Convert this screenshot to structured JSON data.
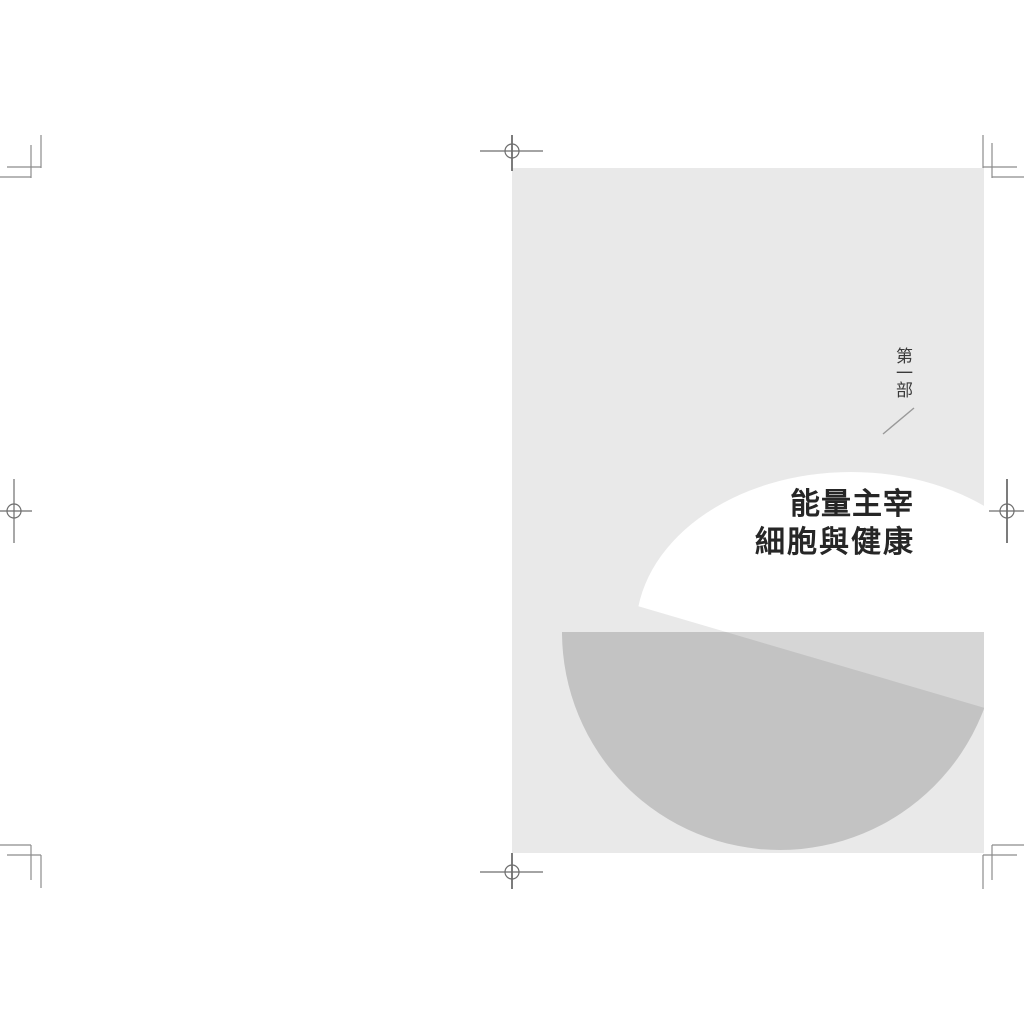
{
  "sheet": {
    "part_label": "第一部",
    "title_line1": "能量主宰",
    "title_line2": "細胞與健康"
  },
  "colors": {
    "sheet_bg": "#ffffff",
    "page_bg": "#e9e9e9",
    "circle_fill": "#ffffff",
    "bowl_fill": "#c3c3c3",
    "bowl_band_fill": "#d6d6d6",
    "trim_mark_stroke": "#8c8c8c",
    "registration_mark_stroke": "#6e6e6e",
    "slash_stroke": "#999999",
    "part_label_color": "#3a3a3a",
    "title_color": "#262626"
  }
}
